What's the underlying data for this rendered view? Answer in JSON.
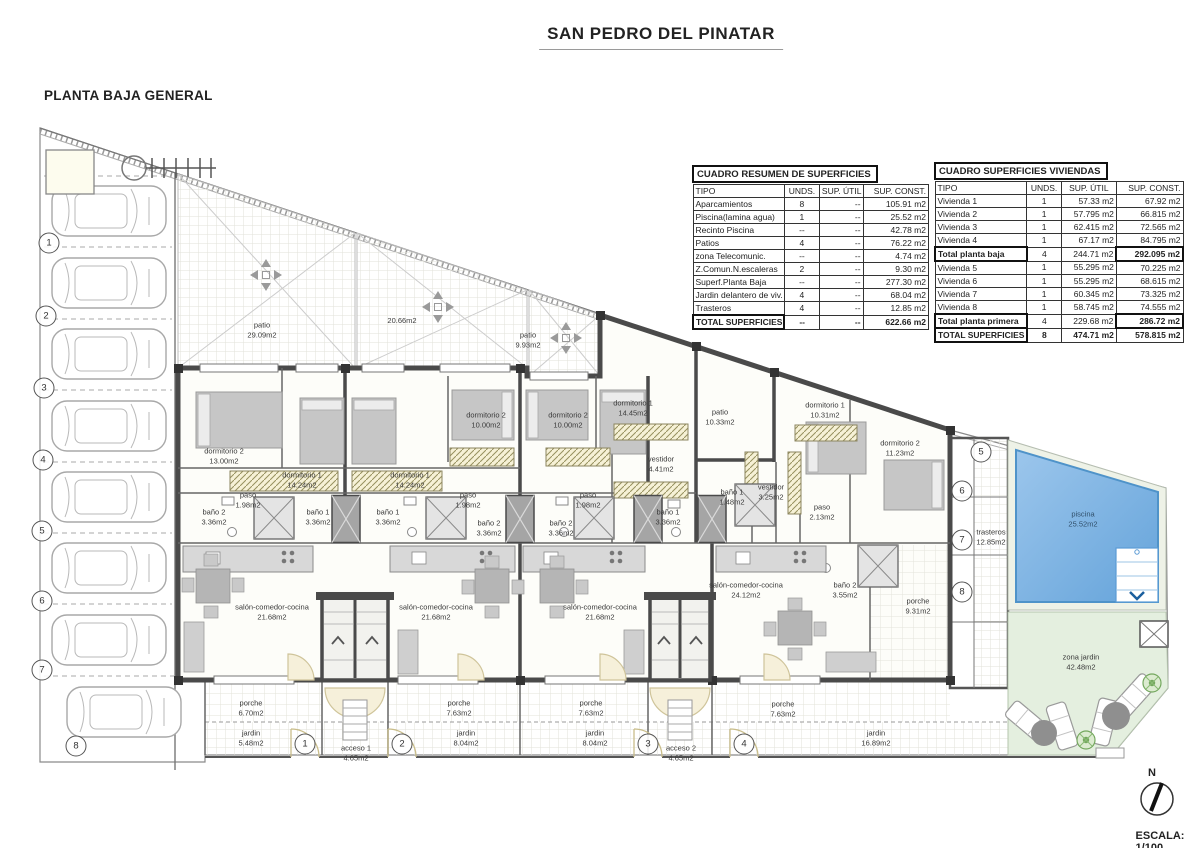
{
  "page": {
    "title": "SAN PEDRO DEL PINATAR",
    "subtitle": "PLANTA BAJA GENERAL",
    "scale_label": "ESCALA: 1/100",
    "north_label": "N"
  },
  "tables": {
    "resumen": {
      "title": "CUADRO RESUMEN DE SUPERFICIES",
      "headers": [
        "TIPO",
        "UNDS.",
        "SUP. ÚTIL",
        "SUP. CONST."
      ],
      "rows": [
        [
          "Aparcamientos",
          "8",
          "--",
          "105.91 m2"
        ],
        [
          "Piscina(lamina agua)",
          "1",
          "--",
          "25.52 m2"
        ],
        [
          "Recinto Piscina",
          "--",
          "--",
          "42.78 m2"
        ],
        [
          "Patios",
          "4",
          "--",
          "76.22 m2"
        ],
        [
          "zona Telecomunic.",
          "--",
          "--",
          "4.74 m2"
        ],
        [
          "Z.Comun.N.escaleras",
          "2",
          "--",
          "9.30 m2"
        ],
        [
          "Superf.Planta Baja",
          "--",
          "--",
          "277.30 m2"
        ],
        [
          "Jardin delantero de viv.",
          "4",
          "--",
          "68.04 m2"
        ],
        [
          "Trasteros",
          "4",
          "--",
          "12.85 m2"
        ],
        [
          "TOTAL SUPERFICIES",
          "--",
          "--",
          "622.66 m2"
        ]
      ]
    },
    "viviendas": {
      "title": "CUADRO SUPERFICIES VIVIENDAS",
      "headers": [
        "TIPO",
        "UNDS.",
        "SUP. ÚTIL",
        "SUP. CONST."
      ],
      "rows": [
        [
          "Vivienda 1",
          "1",
          "57.33 m2",
          "67.92 m2"
        ],
        [
          "Vivienda 2",
          "1",
          "57.795 m2",
          "66.815 m2"
        ],
        [
          "Vivienda 3",
          "1",
          "62.415 m2",
          "72.565 m2"
        ],
        [
          "Vivienda 4",
          "1",
          "67.17 m2",
          "84.795 m2"
        ],
        [
          "Total planta baja",
          "4",
          "244.71 m2",
          "292.095 m2"
        ],
        [
          "Vivienda 5",
          "1",
          "55.295 m2",
          "70.225 m2"
        ],
        [
          "Vivienda 6",
          "1",
          "55.295 m2",
          "68.615 m2"
        ],
        [
          "Vivienda 7",
          "1",
          "60.345 m2",
          "73.325 m2"
        ],
        [
          "Vivienda 8",
          "1",
          "58.745 m2",
          "74.555 m2"
        ],
        [
          "Total planta primera",
          "4",
          "229.68 m2",
          "286.72 m2"
        ],
        [
          "TOTAL SUPERFICIES",
          "8",
          "474.71 m2",
          "578.815 m2"
        ]
      ]
    }
  },
  "plan": {
    "labels": [
      "patio\n29.09m2",
      "20.66m2",
      "patio\n9.93m2",
      "patio\n10.33m2",
      "dormitorio 2\n13.00m2",
      "dormitorio 1\n14.24m2",
      "dormitorio 1\n14.24m2",
      "dormitorio 2\n10.00m2",
      "dormitorio 2\n10.00m2",
      "dormitorio 1\n14.45m2",
      "dormitorio 1\n10.31m2",
      "dormitorio 2\n11.23m2",
      "vestidor\n4.41m2",
      "vestidor\n3.25m2",
      "baño 2\n3.36m2",
      "paso\n1.98m2",
      "baño 1\n3.36m2",
      "baño 1\n3.36m2",
      "paso\n1.98m2",
      "baño 2\n3.36m2",
      "baño 2\n3.36m2",
      "paso\n1.98m2",
      "baño 1\n3.36m2",
      "baño 1\n1.48m2",
      "paso\n2.13m2",
      "baño 2\n3.55m2",
      "salón-comedor-cocina\n21.68m2",
      "salón-comedor-cocina\n21.68m2",
      "salón-comedor-cocina\n21.68m2",
      "salón-comedor-cocina\n24.12m2",
      "porche\n9.31m2",
      "porche\n6.70m2",
      "jardin\n5.48m2",
      "acceso 1\n4.65m2",
      "porche\n7.63m2",
      "jardin\n8.04m2",
      "porche\n7.63m2",
      "jardin\n8.04m2",
      "acceso 2\n4.65m2",
      "porche\n7.63m2",
      "jardin\n16.89m2",
      "trasteros\n12.85m2",
      "piscina\n25.52m2",
      "zona jardin\n42.48m2"
    ],
    "parking_numbers": [
      "1",
      "2",
      "3",
      "4",
      "5",
      "6",
      "7",
      "8"
    ],
    "unit_numbers": [
      "1",
      "2",
      "3",
      "4"
    ],
    "storage_numbers": [
      "5",
      "6",
      "7",
      "8"
    ],
    "colors": {
      "pool": "#74aede",
      "garden": "#e4efdf",
      "wall": "#4a4a4a"
    }
  }
}
